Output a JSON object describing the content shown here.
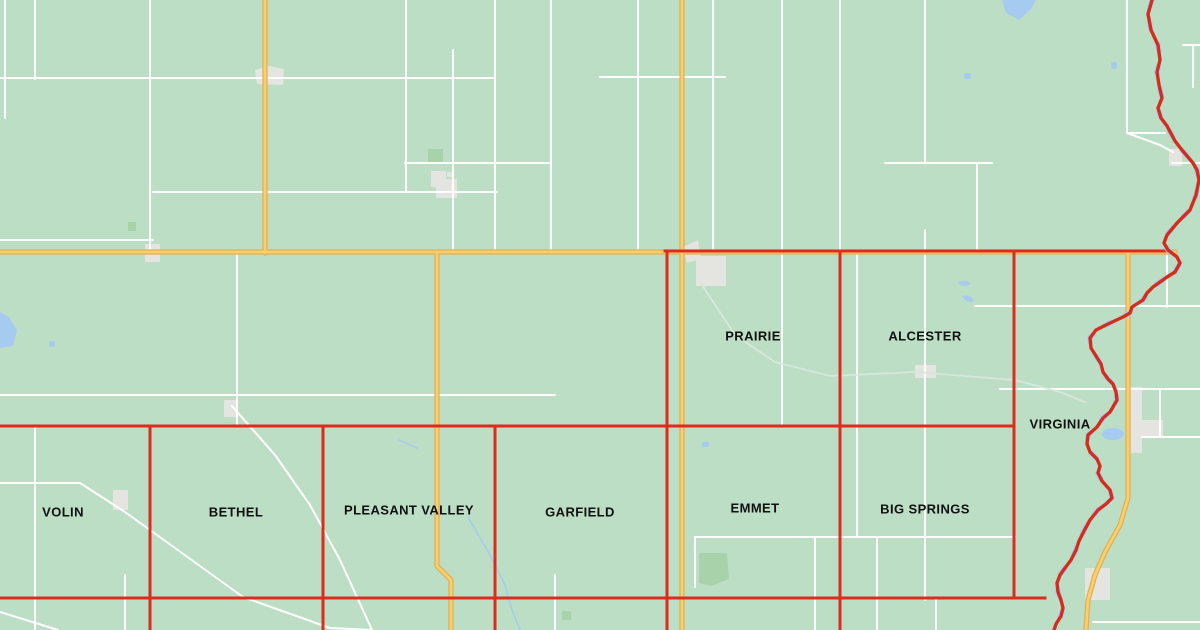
{
  "map": {
    "kind": "county-township-boundary-map",
    "townships": [
      {
        "name": "PRAIRIE"
      },
      {
        "name": "ALCESTER"
      },
      {
        "name": "VIRGINIA"
      },
      {
        "name": "VOLIN"
      },
      {
        "name": "BETHEL"
      },
      {
        "name": "PLEASANT VALLEY"
      },
      {
        "name": "GARFIELD"
      },
      {
        "name": "EMMET"
      },
      {
        "name": "BIG SPRINGS"
      }
    ],
    "colors": {
      "land": "#bcdec5",
      "local-road": "#ffffff",
      "highway": "#f7d06e",
      "highway-casing": "#e3ad52",
      "boundary": "#dd2c1d",
      "state-line-river": "#d42c1e",
      "water": "#a6cbf0",
      "creek": "#d8e7da",
      "urban-area": "#e4e4e1",
      "park": "#a8d2aa",
      "label-text": "#111111"
    },
    "legend": {
      "boundary_meaning": "township boundary",
      "river_meaning": "state line along river",
      "highway_meaning": "paved highway",
      "local_road_meaning": "local road"
    }
  }
}
